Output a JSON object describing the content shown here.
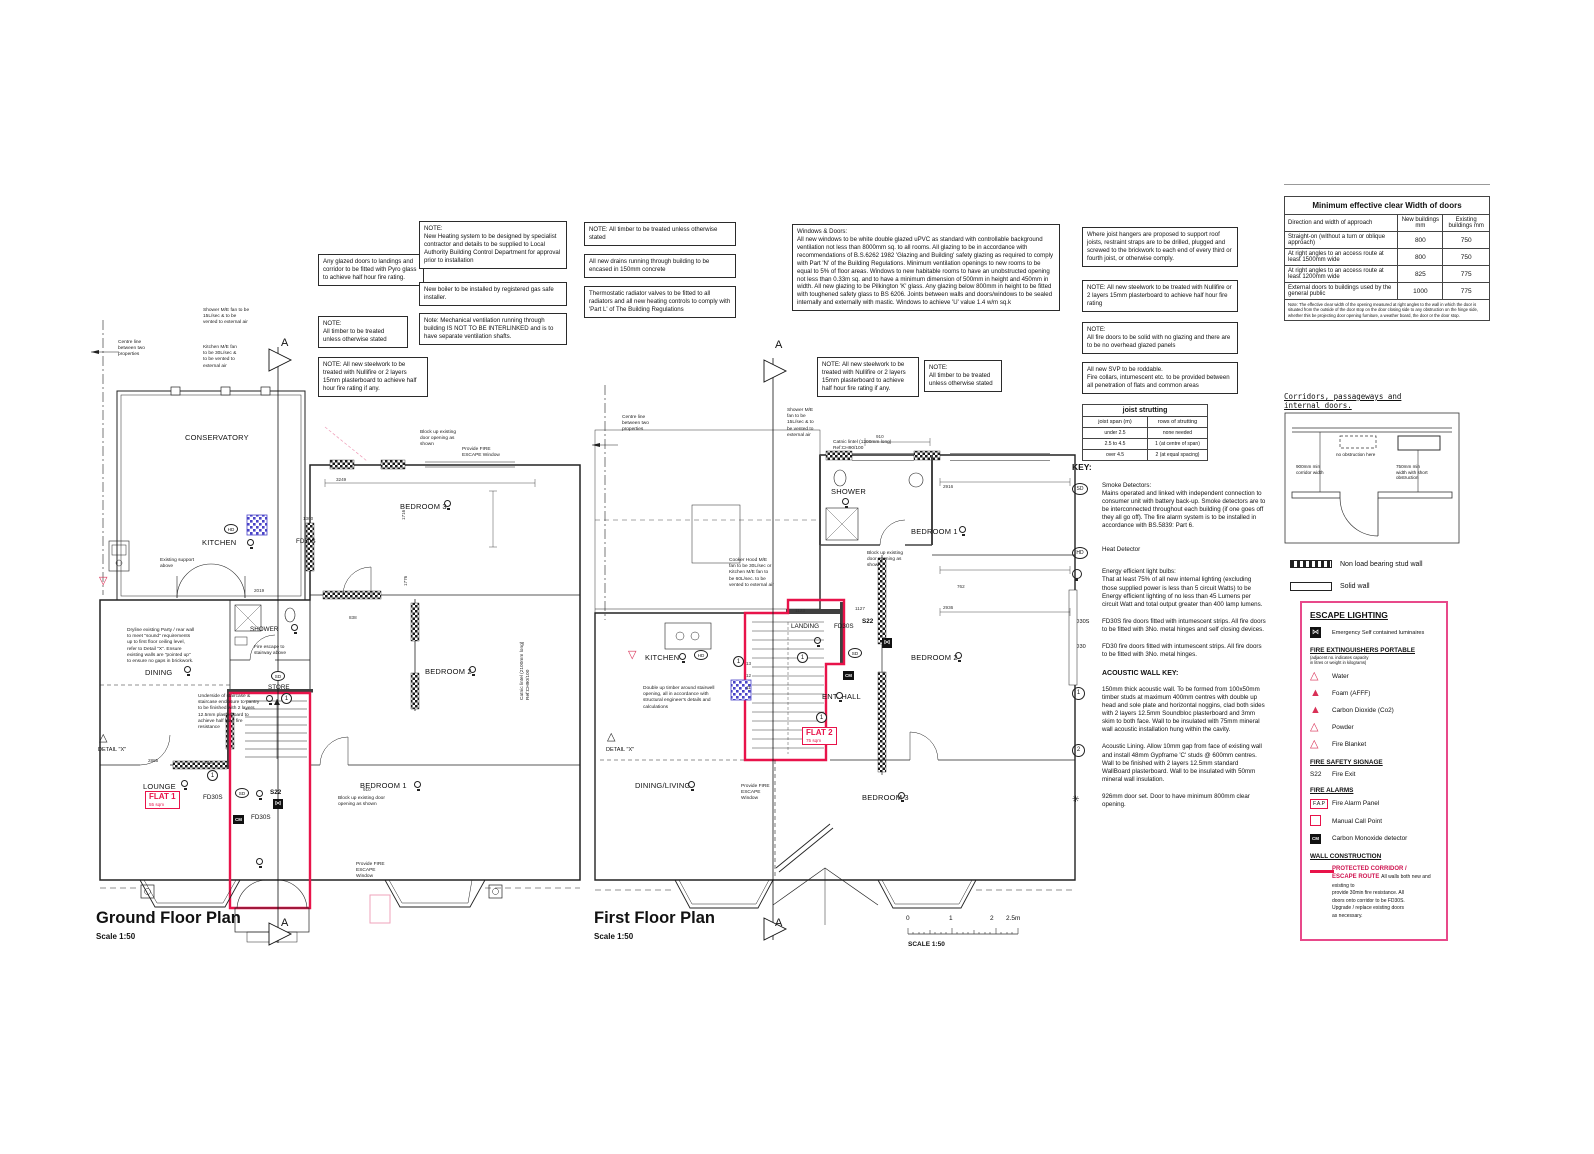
{
  "ground": {
    "title": "Ground Floor Plan",
    "scale": "Scale 1:50",
    "flat": {
      "name": "FLAT 1",
      "area": "55 sqm"
    }
  },
  "first": {
    "title": "First Floor Plan",
    "scale": "Scale 1:50",
    "flat": {
      "name": "FLAT 2",
      "area": "75 sqm"
    }
  },
  "scalebar": {
    "t0": "0",
    "t1": "1",
    "t2": "2",
    "t25": "2.5m",
    "label": "SCALE 1:50"
  },
  "notes": {
    "glazed": "Any glazed doors to landings and corridor to be fitted with Pyro glass to achieve half hour fire rating.",
    "timber1": "NOTE:\nAll timber to be treated unless otherwise stated",
    "steel1": "NOTE: All new steelwork to be treated with Nullifire or 2 layers 15mm plasterboard to achieve half hour fire rating if any.",
    "heating": "NOTE:\nNew Heating system to be designed by specialist contractor and details to be supplied to Local Authority Building Control Department for approval prior to installation",
    "boiler": "New boiler to be installed by registered gas safe installer.",
    "mechvent": "Note: Mechanical ventilation running through building IS NOT TO BE INTERLINKED and is to have separate ventilation shafts.",
    "timber2": "NOTE: All timber to be treated unless otherwise stated",
    "drains": "All new drains running through building to be encased in 150mm concrete",
    "trv": "Thermostatic radiator valves to be fitted to all radiators and all new heating controls to comply with 'Part L' of The Building Regulations",
    "windows": "Windows & Doors:\nAll new windows to be white double glazed uPVC as standard with controllable background ventilation not less than 8000mm sq. to all rooms.  All glazing to be in accordance with recommendations of B.S.6262 1982 'Glazing and Building' safety glazing as required to comply with Part 'N' of the Building Regulations. Minimum ventilation openings to new rooms to be equal to 5% of floor areas. Windows to new habitable rooms to have an unobstructed opening not less than 0.33m sq. and to have a minimum dimension of 500mm in height and 450mm in width. All new glazing to be Pilkington 'K' glass. Any glazing below 800mm in height to be fitted with toughened safety glass to BS 6206. Joints between walls and doors/windows to be sealed internally and externally with mastic. Windows to achieve 'U' value 1.4 w/m sq.k",
    "joist_hangers": "Where joist hangers are proposed to support roof joists, restraint straps are to be drilled, plugged and screwed to the brickwork to each end of every third or fourth joist, or otherwise comply.",
    "steel2": "NOTE: All new steelwork to be treated with Nullifire or 2 layers 15mm plasterboard to achieve half hour fire rating",
    "firedoors": "NOTE:\nAll fire doors to be solid with no glazing and there are to be no overhead glazed panels",
    "svp": "All new SVP to be roddable.\nFire collars, intumescent etc. to be provided between all penetration of flats and common areas",
    "steel_ff": "NOTE: All new steelwork to be treated with Nullifire or 2 layers 15mm plasterboard to achieve half hour fire rating if any.",
    "timber_ff": "NOTE:\nAll timber to be treated unless otherwise stated"
  },
  "door_table": {
    "title": "Minimum effective clear Width of doors",
    "col_approach": "Direction and width of approach",
    "col_new": "New buildings mm",
    "col_existing": "Existing buildings mm",
    "rows": [
      {
        "approach": "Straight-on (without a turn or oblique approach)",
        "new": "800",
        "existing": "750"
      },
      {
        "approach": "At right angles to an access route at least 1500mm wide",
        "new": "800",
        "existing": "750"
      },
      {
        "approach": "At right angles to an access route at least 1200mm wide",
        "new": "825",
        "existing": "775"
      },
      {
        "approach": "External doors to buildings used by the general public",
        "new": "1000",
        "existing": "775"
      }
    ],
    "footnote": "Note: The effective clear width of the opening measured at right angles to the wall in which the door is situated from the outside of the door stop on the door closing side to any obstruction on the hinge side, whether this be projecting door opening furniture, a weather board, the door or the door stop."
  },
  "joist_table": {
    "title": "joist strutting",
    "col_span": "joist span (m)",
    "col_rows": "rows of strutting",
    "rows": [
      {
        "span": "under 2.5",
        "strutting": "none needed"
      },
      {
        "span": "2.5 to 4.5",
        "strutting": "1 (at centre of span)"
      },
      {
        "span": "over 4.5",
        "strutting": "2 (at equal spacing)"
      }
    ]
  },
  "key": {
    "heading": "KEY:",
    "sd_symbol": "SD",
    "sd_text": "Smoke Detectors:\nMains operated and linked with independent connection to consumer unit with battery back-up. Smoke detectors are to be interconnected throughout each building (if one goes off they all go off). The fire alarm system is to be installed in accordance with BS.5839: Part 6.",
    "hd_symbol": "HD",
    "hd_text": "Heat Detector",
    "bulb_text": "Energy efficient light bulbs:\nThat at least 75% of all new internal lighting (excluding those supplied power is less than 5 circuit Watts) to be Energy efficient lighting of no less than 45 Lumens per circuit Watt and total output greater than 400 lamp lumens.",
    "fd30s_symbol": "FD30S",
    "fd30s_text": "FD30S fire doors fitted with intumescent strips. All fire doors to be fitted with 3No. metal hinges and self closing devices.",
    "fd30_symbol": "FD30",
    "fd30_text": "FD30 fire doors fitted with intumescent strips. All fire doors to be fitted with 3No. metal hinges.",
    "acoustic_heading": "ACOUSTIC WALL KEY:",
    "a1_symbol": "1",
    "a1_text": "150mm thick acoustic wall. To be formed from 100x50mm timber studs at maximum 400mm centres with double up head and sole plate and horizontal noggins, clad both sides with 2 layers 12.5mm Soundbloc plasterboard and 3mm skim to both face. Wall to be insulated with 75mm mineral wall acoustic installation hung within the cavity.",
    "a2_symbol": "2",
    "a2_text": "Acoustic Lining. Allow 10mm gap from face of existing wall and install 48mm Gypframe 'C' studs @ 600mm centres. Wall to be finished with 2 layers 12.5mm standard WallBoard plasterboard. Wall to be insulated with 50mm mineral wall insulation.",
    "door_symbol": "✳",
    "door_text": "926mm door set. Door to have minimum 800mm clear opening."
  },
  "corridor_diagram": {
    "heading": "Corridors, passageways and\ninternal doors.",
    "no_obstruction": "no obstruction here",
    "corridor_width": "900mm min\ncorridor width",
    "short_obstruction": "750mm min\nwidth with short\nobstruction"
  },
  "wall_legend": {
    "stud": "Non load bearing stud wall",
    "solid": "Solid wall"
  },
  "escape": {
    "lighting_heading": "ESCAPE LIGHTING",
    "luminaires": "Emergency Self contained luminaires",
    "lum_glyph": "⋈",
    "ext_heading": "FIRE EXTINGUISHERS PORTABLE",
    "ext_sub": "(adjacent no. indicates capacity\nin litres or weight in kilograms)",
    "water": "Water",
    "foam": "Foam (AFFF)",
    "co2": "Carbon Dioxide (Co2)",
    "powder": "Powder",
    "blanket": "Fire Blanket",
    "signage_heading": "FIRE SAFETY SIGNAGE",
    "s22_code": "S22",
    "s22_label": "Fire Exit",
    "alarms_heading": "FIRE ALARMS",
    "fap_code": "F.A.P",
    "fap_label": "Fire Alarm Panel",
    "mcp_label": "Manual Call Point",
    "cm_code": "CM",
    "cm_label": "Carbon Monoxide detector",
    "wall_heading": "WALL CONSTRUCTION",
    "protected_title": "PROTECTED CORRIDOR /\nESCAPE ROUTE",
    "protected_text": "All walls both new and existing to\nprovide 30min fire resistance. All\ndoors onto corridor to be FD30S.\nUpgrade / replace existing doors\nas necessary."
  },
  "colors": {
    "escape_red": "#e8134a",
    "legend_pink": "#e8498a",
    "blue_hatch": "#4943c8",
    "triangle_red": "#d93056"
  },
  "plan_labels": [
    {
      "t": "Centre line\nbetween two\nproperties",
      "x": 118,
      "y": 340,
      "c": "tiny"
    },
    {
      "t": "Shower M/E fan to be\n15L/sec & to be\nvented to external air",
      "x": 203,
      "y": 308,
      "c": "tiny"
    },
    {
      "t": "Kitchen M/E fan\nto be 30L/sec &\nto be vented to\nexternal air",
      "x": 203,
      "y": 345,
      "c": "tiny"
    },
    {
      "t": "CONSERVATORY",
      "x": 185,
      "y": 433,
      "c": "room"
    },
    {
      "t": "KITCHEN",
      "x": 202,
      "y": 538,
      "c": "room"
    },
    {
      "t": "Existing support\nabove",
      "x": 160,
      "y": 558,
      "c": "tiny"
    },
    {
      "t": "FD30S",
      "x": 296,
      "y": 538,
      "c": "room-s"
    },
    {
      "t": "DINING",
      "x": 145,
      "y": 668,
      "c": "room"
    },
    {
      "t": "SHOWER",
      "x": 250,
      "y": 626,
      "c": "room-s"
    },
    {
      "t": "STORE",
      "x": 268,
      "y": 684,
      "c": "room-s"
    },
    {
      "t": "LOUNGE",
      "x": 143,
      "y": 782,
      "c": "room"
    },
    {
      "t": "BEDROOM 1",
      "x": 360,
      "y": 781,
      "c": "room"
    },
    {
      "t": "BEDROOM 2",
      "x": 425,
      "y": 667,
      "c": "room"
    },
    {
      "t": "BEDROOM 3",
      "x": 400,
      "y": 502,
      "c": "room"
    },
    {
      "t": "FD30S",
      "x": 203,
      "y": 794,
      "c": "room-s"
    },
    {
      "t": "FD30S",
      "x": 251,
      "y": 814,
      "c": "room-s"
    },
    {
      "t": "S22",
      "x": 270,
      "y": 789,
      "c": "room-s b"
    },
    {
      "t": "Dryline existing Party / rear wall\nto meet \"sound\" requirements\nup to first floor ceiling level,\nrefer to Detail \"X\". Ensure\nexisting walls are \"pointed up\"\nto ensure no gaps in brickwork.",
      "x": 127,
      "y": 628,
      "c": "tiny"
    },
    {
      "t": "Underside of staircase &\nstaircase enclosure to pantry\nto be finished with 2 layers\n12.5mm plasterboard to\nachieve half hour fire\nresistance",
      "x": 198,
      "y": 694,
      "c": "tiny"
    },
    {
      "t": "Fire escape to\nstairway above",
      "x": 254,
      "y": 645,
      "c": "tiny"
    },
    {
      "t": "DETAIL \"X\"",
      "x": 98,
      "y": 747,
      "c": "det"
    },
    {
      "t": "Block up existing\ndoor opening as\nshown",
      "x": 420,
      "y": 430,
      "c": "tiny"
    },
    {
      "t": "Provide FIRE\nESCAPE Window",
      "x": 462,
      "y": 447,
      "c": "tiny"
    },
    {
      "t": "Block up existing door\nopening as shown",
      "x": 338,
      "y": 796,
      "c": "tiny"
    },
    {
      "t": "910",
      "x": 363,
      "y": 787,
      "c": "dim"
    },
    {
      "t": "Provide FIRE\nESCAPE\nWindow",
      "x": 356,
      "y": 862,
      "c": "tiny"
    },
    {
      "t": "Catnic lintel (2100mm long)\nRef:CH90/100",
      "x": 520,
      "y": 700,
      "c": "tiny vert"
    },
    {
      "t": "2019",
      "x": 254,
      "y": 588,
      "c": "dim"
    },
    {
      "t": "3249",
      "x": 336,
      "y": 477,
      "c": "dim"
    },
    {
      "t": "1300",
      "x": 303,
      "y": 516,
      "c": "dim"
    },
    {
      "t": "1716",
      "x": 401,
      "y": 520,
      "c": "dim vert"
    },
    {
      "t": "1776",
      "x": 403,
      "y": 586,
      "c": "dim vert"
    },
    {
      "t": "2885",
      "x": 148,
      "y": 758,
      "c": "dim"
    },
    {
      "t": "734",
      "x": 204,
      "y": 760,
      "c": "dim"
    },
    {
      "t": "838",
      "x": 349,
      "y": 615,
      "c": "dim"
    },
    {
      "t": "Ground Floor Plan",
      "x": 96,
      "y": 908,
      "c": "plantitle"
    },
    {
      "t": "Scale 1:50",
      "x": 96,
      "y": 932,
      "c": "planscale"
    },
    {
      "t": "A",
      "x": 281,
      "y": 336,
      "c": "secA"
    },
    {
      "t": "A",
      "x": 281,
      "y": 916,
      "c": "secA"
    },
    {
      "t": "Centre line\nbetween two\nproperties",
      "x": 622,
      "y": 415,
      "c": "tiny"
    },
    {
      "t": "Shower M/E\nfan to be\n15L/sec & to\nbe vented to\nexternal air",
      "x": 787,
      "y": 408,
      "c": "tiny"
    },
    {
      "t": "Catnic lintel (1200mm long)\nRef:CH90/100",
      "x": 833,
      "y": 440,
      "c": "tiny"
    },
    {
      "t": "910",
      "x": 876,
      "y": 434,
      "c": "dim"
    },
    {
      "t": "SHOWER",
      "x": 831,
      "y": 487,
      "c": "room"
    },
    {
      "t": "BEDROOM 1",
      "x": 911,
      "y": 527,
      "c": "room"
    },
    {
      "t": "2916",
      "x": 943,
      "y": 484,
      "c": "dim"
    },
    {
      "t": "Cooker Hood M/E\nfan to be 30L/sec or\nKitchen M/E fan to\nbe 60L/sec. to be\nvented to external air",
      "x": 729,
      "y": 558,
      "c": "tiny"
    },
    {
      "t": "Block up existing\ndoor opening as\nshown",
      "x": 867,
      "y": 551,
      "c": "tiny"
    },
    {
      "t": "LANDING",
      "x": 791,
      "y": 623,
      "c": "room-s"
    },
    {
      "t": "FD30S",
      "x": 834,
      "y": 623,
      "c": "room-s"
    },
    {
      "t": "S22",
      "x": 862,
      "y": 618,
      "c": "room-s b"
    },
    {
      "t": "KITCHEN",
      "x": 645,
      "y": 653,
      "c": "room"
    },
    {
      "t": "BEDROOM 2",
      "x": 911,
      "y": 653,
      "c": "room"
    },
    {
      "t": "ENT. HALL",
      "x": 822,
      "y": 692,
      "c": "room"
    },
    {
      "t": "DINING/LIVING",
      "x": 635,
      "y": 781,
      "c": "room"
    },
    {
      "t": "BEDROOM 3",
      "x": 862,
      "y": 793,
      "c": "room"
    },
    {
      "t": "Double up timber around stairwell\nopening, all in accordance with\nstructural engineer's details and\ncalculations",
      "x": 643,
      "y": 686,
      "c": "tiny"
    },
    {
      "t": "DETAIL \"X\"",
      "x": 606,
      "y": 747,
      "c": "det"
    },
    {
      "t": "Provide FIRE\nESCAPE\nWindow",
      "x": 741,
      "y": 784,
      "c": "tiny"
    },
    {
      "t": "1123",
      "x": 795,
      "y": 608,
      "c": "dim"
    },
    {
      "t": "1127",
      "x": 855,
      "y": 606,
      "c": "dim"
    },
    {
      "t": "2936",
      "x": 943,
      "y": 605,
      "c": "dim"
    },
    {
      "t": "762",
      "x": 957,
      "y": 584,
      "c": "dim"
    },
    {
      "t": "13",
      "x": 746,
      "y": 661,
      "c": "dim"
    },
    {
      "t": "12",
      "x": 746,
      "y": 673,
      "c": "dim"
    },
    {
      "t": "11",
      "x": 746,
      "y": 685,
      "c": "dim"
    },
    {
      "t": "First Floor Plan",
      "x": 594,
      "y": 908,
      "c": "plantitle"
    },
    {
      "t": "Scale 1:50",
      "x": 594,
      "y": 932,
      "c": "planscale"
    },
    {
      "t": "A",
      "x": 775,
      "y": 338,
      "c": "secA"
    },
    {
      "t": "A",
      "x": 775,
      "y": 916,
      "c": "secA"
    }
  ],
  "plan_symbols": [
    {
      "k": "hd",
      "x": 224,
      "y": 524,
      "t": "HD"
    },
    {
      "k": "bulb",
      "x": 247,
      "y": 539
    },
    {
      "k": "bulb",
      "x": 184,
      "y": 666
    },
    {
      "k": "bulb",
      "x": 291,
      "y": 624
    },
    {
      "k": "sd",
      "x": 271,
      "y": 671,
      "t": "SD"
    },
    {
      "k": "bulb",
      "x": 266,
      "y": 695
    },
    {
      "k": "c1",
      "x": 281,
      "y": 693,
      "t": "1"
    },
    {
      "k": "bulb",
      "x": 181,
      "y": 780
    },
    {
      "k": "c1",
      "x": 207,
      "y": 770,
      "t": "1"
    },
    {
      "k": "sd",
      "x": 235,
      "y": 788,
      "t": "SD"
    },
    {
      "k": "bulb",
      "x": 256,
      "y": 790
    },
    {
      "k": "exit",
      "x": 273,
      "y": 799,
      "t": "⋈"
    },
    {
      "k": "cm",
      "x": 233,
      "y": 815,
      "t": "CM"
    },
    {
      "k": "bulb",
      "x": 256,
      "y": 858
    },
    {
      "k": "bulb",
      "x": 414,
      "y": 781
    },
    {
      "k": "bulb",
      "x": 469,
      "y": 666
    },
    {
      "k": "bulb",
      "x": 444,
      "y": 500
    },
    {
      "k": "trio",
      "x": 99,
      "y": 733,
      "t": "△"
    },
    {
      "k": "trired",
      "x": 99,
      "y": 576,
      "t": "▽"
    },
    {
      "k": "trired",
      "x": 628,
      "y": 650,
      "t": "▽"
    },
    {
      "k": "bulb",
      "x": 842,
      "y": 498
    },
    {
      "k": "bulb",
      "x": 959,
      "y": 526
    },
    {
      "k": "bulb",
      "x": 955,
      "y": 652
    },
    {
      "k": "bulb",
      "x": 898,
      "y": 792
    },
    {
      "k": "bulb",
      "x": 688,
      "y": 781
    },
    {
      "k": "hd",
      "x": 694,
      "y": 650,
      "t": "HD"
    },
    {
      "k": "bulb",
      "x": 679,
      "y": 653
    },
    {
      "k": "bulb",
      "x": 814,
      "y": 637
    },
    {
      "k": "c1",
      "x": 797,
      "y": 652,
      "t": "1"
    },
    {
      "k": "c1",
      "x": 733,
      "y": 656,
      "t": "1"
    },
    {
      "k": "c1",
      "x": 816,
      "y": 712,
      "t": "1"
    },
    {
      "k": "sd",
      "x": 848,
      "y": 648,
      "t": "SD"
    },
    {
      "k": "cm",
      "x": 843,
      "y": 671,
      "t": "CM"
    },
    {
      "k": "exit",
      "x": 882,
      "y": 638,
      "t": "⋈"
    },
    {
      "k": "bulb",
      "x": 836,
      "y": 692
    },
    {
      "k": "trio",
      "x": 607,
      "y": 732,
      "t": "△"
    }
  ]
}
